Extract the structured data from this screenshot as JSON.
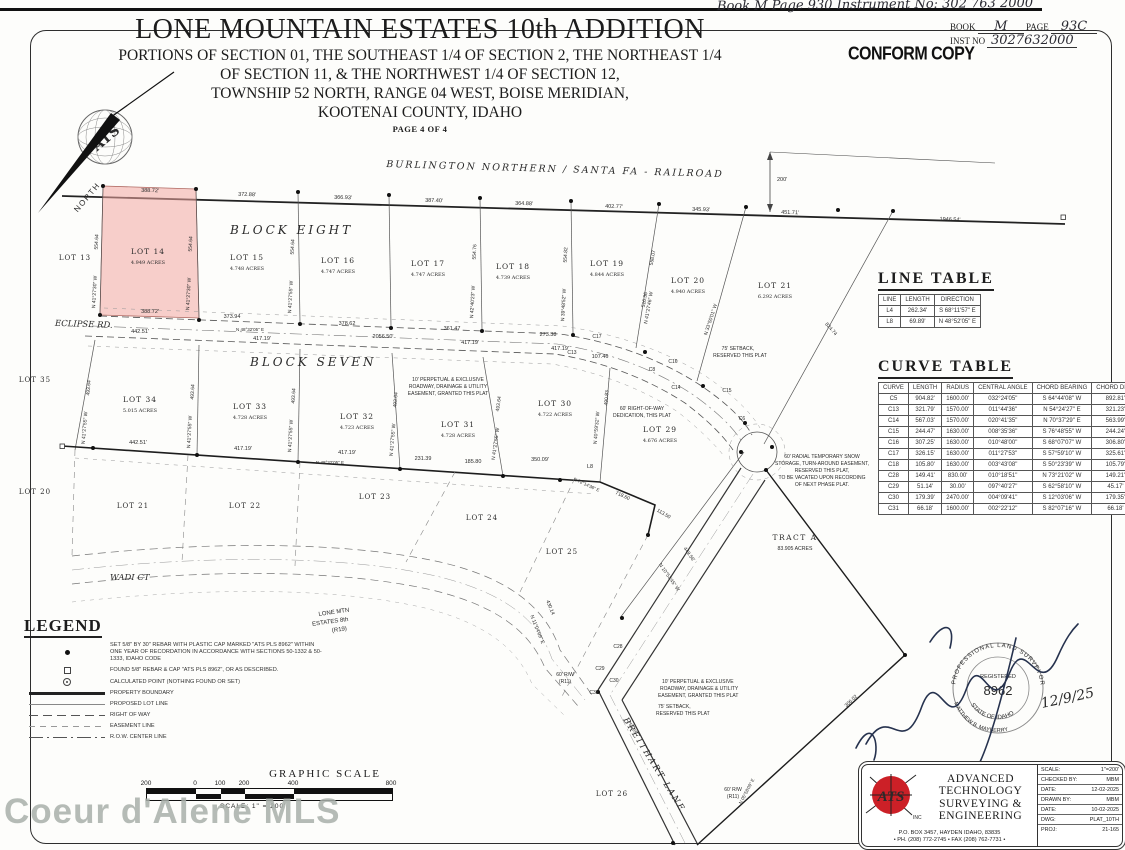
{
  "header": {
    "handwritten_top": "Book  M   Page 930     Instrument No:  302 763 2000",
    "book_label": "BOOK",
    "book_value": "M",
    "page_label": "PAGE",
    "page_value": "93C",
    "inst_label": "INST NO",
    "inst_value": "3027632000",
    "conform_stamp": "CONFORM COPY"
  },
  "title": {
    "main": "LONE MOUNTAIN ESTATES 10th ADDITION",
    "sub1": "PORTIONS OF SECTION 01, THE SOUTHEAST 1/4 OF SECTION 2, THE NORTHEAST 1/4",
    "sub2": "OF SECTION 11, & THE NORTHWEST 1/4 OF SECTION 12,",
    "sub3": "TOWNSHIP 52 NORTH, RANGE 04 WEST, BOISE MERIDIAN,",
    "sub4": "KOOTENAI COUNTY, IDAHO",
    "page": "PAGE 4 OF 4"
  },
  "map": {
    "railroad_label": "BURLINGTON  NORTHERN   /  SANTA  FA   -   RAILROAD",
    "north_label": "NORTH",
    "block_eight": "BLOCK   EIGHT",
    "block_seven": "BLOCK   SEVEN",
    "eclipse_rd": "ECLIPSE  RD.",
    "wadi_ct": "WADI  CT",
    "breithart_lane": "BREITHART  LANE",
    "tract_name": "TRACT   A",
    "tract_acres": "83.905 ACRES",
    "lots": [
      {
        "name": "LOT  14",
        "acres": "4.949 ACRES"
      },
      {
        "name": "LOT  15",
        "acres": "4.748 ACRES"
      },
      {
        "name": "LOT  16",
        "acres": "4.747 ACRES"
      },
      {
        "name": "LOT  17",
        "acres": "4.747 ACRES"
      },
      {
        "name": "LOT  18",
        "acres": "4.739 ACRES"
      },
      {
        "name": "LOT  19",
        "acres": "4.844 ACRES"
      },
      {
        "name": "LOT  20",
        "acres": "4.940 ACRES"
      },
      {
        "name": "LOT  21",
        "acres": "6.292 ACRES"
      },
      {
        "name": "LOT  34",
        "acres": "5.015 ACRES"
      },
      {
        "name": "LOT  33",
        "acres": "4.728 ACRES"
      },
      {
        "name": "LOT  32",
        "acres": "4.723 ACRES"
      },
      {
        "name": "LOT  31",
        "acres": "4.728 ACRES"
      },
      {
        "name": "LOT  30",
        "acres": "4.722 ACRES"
      },
      {
        "name": "LOT  29",
        "acres": "4.676 ACRES"
      }
    ],
    "adjacent_lots": [
      "LOT  13",
      "LOT  35",
      "LOT  20",
      "LOT  21",
      "LOT  22",
      "LOT  23",
      "LOT  24",
      "LOT  25",
      "LOT  26"
    ],
    "dims_top": [
      "388.72'",
      "372.88'",
      "366.93'",
      "387.40'",
      "364.88'",
      "402.77'",
      "345.93'",
      "451.71'",
      "1946.54'",
      "200'"
    ],
    "dims_mid": [
      "388.72'",
      "373.94",
      "378.62",
      "361.47",
      "273.38",
      "442.51'",
      "N 48°32'05\" E",
      "417.19'",
      "2056.50'",
      "417.19'",
      "417.19'",
      "107.46"
    ],
    "dims_bottom": [
      "442.51'",
      "417.19'",
      "N 48°32'05\" E",
      "417.19'",
      "231.39",
      "185.80",
      "350.09'",
      "L8"
    ],
    "edge_lengths_b8": [
      "554.64",
      "554.64",
      "554.64",
      "554.76",
      "554.82",
      "558.07"
    ],
    "edge_bearings_b8": [
      "N 41°27'30\" W",
      "N 41°27'30\" W",
      "N 41°27'55\" W",
      "N 42°40'23\" W",
      "N 39°48'52\" W",
      "N 41°27'46\" W"
    ],
    "edge_lengths_b7": [
      "493.64",
      "493.64",
      "493.64",
      "493.64",
      "493.64"
    ],
    "edge_bearing_b7": "N 41°27'55\" W",
    "misc_dims": {
      "d490": "490.83",
      "b490": "N 40°59'32\" W",
      "d449": "449.56'",
      "b449": "N 10°53'45\" W",
      "d718": "718.60",
      "b718": "N 72°14'36\" E",
      "d113": "113.50",
      "d824": "824.74",
      "d306": "306.02",
      "d430": "430.14",
      "b430": "N 11°04'09\" E",
      "d750": "750.55",
      "b750": "N 05°58'09\" E",
      "d516": "516.36",
      "b516": "N 33°50'01\" W"
    },
    "curve_labels": {
      "c6": "C6",
      "c8": "C8",
      "c13": "C13",
      "c14": "C14",
      "c15": "C15",
      "c16": "C16",
      "c17": "C17",
      "c28": "C28",
      "c29": "C29",
      "c30": "C30",
      "c31": "C31",
      "l8": "L8"
    },
    "notes": {
      "easement": [
        "10' PERPETUAL & EXCLUSIVE",
        "ROADWAY, DRAINAGE & UTILITY",
        "EASEMENT, GRANTED THIS PLAT"
      ],
      "setback75": [
        "75' SETBACK,",
        "RESERVED THIS PLAT"
      ],
      "row60": [
        "60' RIGHT-OF-WAY",
        "DEDICATION, THIS PLAT"
      ],
      "snow": [
        "60' RADIAL TEMPORARY SNOW",
        "STORAGE, TURN-AROUND EASEMENT,",
        "RESERVED THIS PLAT,",
        "TO BE VACATED UPON RECORDING",
        "OF NEXT PHASE PLAT."
      ],
      "rw60": [
        "60' R/W",
        "(R11)"
      ],
      "adjacent_plat": [
        "LONE  MTN",
        "ESTATES  8th",
        "(R19)"
      ]
    }
  },
  "line_table": {
    "title": "LINE  TABLE",
    "headers": [
      "LINE",
      "LENGTH",
      "DIRECTION"
    ],
    "rows": [
      [
        "L4",
        "262.34'",
        "S 68°11'57\" E"
      ],
      [
        "L8",
        "69.89'",
        "N 48°52'05\" E"
      ]
    ]
  },
  "curve_table": {
    "title": "CURVE  TABLE",
    "headers": [
      "CURVE",
      "LENGTH",
      "RADIUS",
      "CENTRAL ANGLE",
      "CHORD BEARING",
      "CHORD DIST."
    ],
    "rows": [
      [
        "C5",
        "904.82'",
        "1600.00'",
        "032°24'05\"",
        "S 64°44'08\" W",
        "892.81'"
      ],
      [
        "C13",
        "321.79'",
        "1570.00'",
        "011°44'36\"",
        "N 54°24'27\" E",
        "321.23'"
      ],
      [
        "C14",
        "567.03'",
        "1570.00'",
        "020°41'35\"",
        "N 70°37'29\" E",
        "563.99'"
      ],
      [
        "C15",
        "244.47'",
        "1630.00'",
        "008°35'36\"",
        "S 76°48'55\" W",
        "244.24'"
      ],
      [
        "C16",
        "307.25'",
        "1630.00'",
        "010°48'00\"",
        "S 68°07'07\" W",
        "306.80'"
      ],
      [
        "C17",
        "326.15'",
        "1630.00'",
        "011°27'53\"",
        "S 57°59'10\" W",
        "325.61'"
      ],
      [
        "C18",
        "105.80'",
        "1630.00'",
        "003°43'08\"",
        "S 50°23'39\" W",
        "105.79'"
      ],
      [
        "C28",
        "149.41'",
        "830.00'",
        "010°18'51\"",
        "N 73°21'02\" W",
        "149.21'"
      ],
      [
        "C29",
        "51.14'",
        "30.00'",
        "097°40'27\"",
        "S 62°58'10\" W",
        "45.17'"
      ],
      [
        "C30",
        "179.39'",
        "2470.00'",
        "004°09'41\"",
        "S 12°03'06\" W",
        "179.35'"
      ],
      [
        "C31",
        "66.18'",
        "1600.00'",
        "002°22'12\"",
        "S 82°07'16\" W",
        "66.18'"
      ]
    ]
  },
  "legend": {
    "title": "LEGEND",
    "items": [
      {
        "symbol": "set-rebar-dot",
        "text": "SET 5/8\" BY 30\" REBAR WITH PLASTIC CAP MARKED \"ATS PLS 8962\" WITHIN ONE YEAR OF RECORDATION IN ACCORDANCE WITH SECTIONS 50-1332 & 50-1333, IDAHO CODE"
      },
      {
        "symbol": "found-rebar-square",
        "text": "FOUND 5/8\" REBAR & CAP \"ATS PLS 8962\", OR AS DESCRIBED."
      },
      {
        "symbol": "calculated-point",
        "text": "CALCULATED POINT (NOTHING FOUND OR SET)"
      },
      {
        "symbol": "property-boundary-line",
        "text": "PROPERTY BOUNDARY"
      },
      {
        "symbol": "proposed-lot-line",
        "text": "PROPOSED LOT LINE"
      },
      {
        "symbol": "right-of-way-line",
        "text": "RIGHT OF WAY"
      },
      {
        "symbol": "easement-line",
        "text": "EASEMENT LINE"
      },
      {
        "symbol": "row-center-line",
        "text": "R.O.W. CENTER LINE"
      }
    ]
  },
  "scale_bar": {
    "title": "GRAPHIC  SCALE",
    "ticks": [
      "200",
      "0",
      "100",
      "200",
      "400",
      "800"
    ],
    "note": "SCALE:  1\" = 200'"
  },
  "watermark": "Coeur d'Alene MLS",
  "title_block": {
    "company": [
      "ADVANCED",
      "TECHNOLOGY",
      "SURVEYING &",
      "ENGINEERING"
    ],
    "logo_text": "ATS",
    "logo_inc": "INC.",
    "address": "P.O. BOX 3457, HAYDEN IDAHO, 83835",
    "phone": "• PH. (208) 772-2745  •  FAX (208) 762-7731 •",
    "fields": [
      {
        "label": "SCALE:",
        "value": "1\"=200'"
      },
      {
        "label": "CHECKED BY:",
        "value": "MBM"
      },
      {
        "label": "DATE:",
        "value": "12-02-2025"
      },
      {
        "label": "DRAWN BY:",
        "value": "MBM"
      },
      {
        "label": "DATE:",
        "value": "10-02-2025"
      },
      {
        "label": "DWG:",
        "value": "PLAT_10TH"
      },
      {
        "label": "PROJ:",
        "value": "21-165"
      }
    ]
  },
  "stamp": {
    "arc_top": "PROFESSIONAL LAND SURVEYOR",
    "registered": "REGISTERED",
    "number": "8962",
    "state": "STATE OF IDAHO",
    "name": "MATTHEW B. MAYBERRY",
    "date": "12/9/25"
  }
}
